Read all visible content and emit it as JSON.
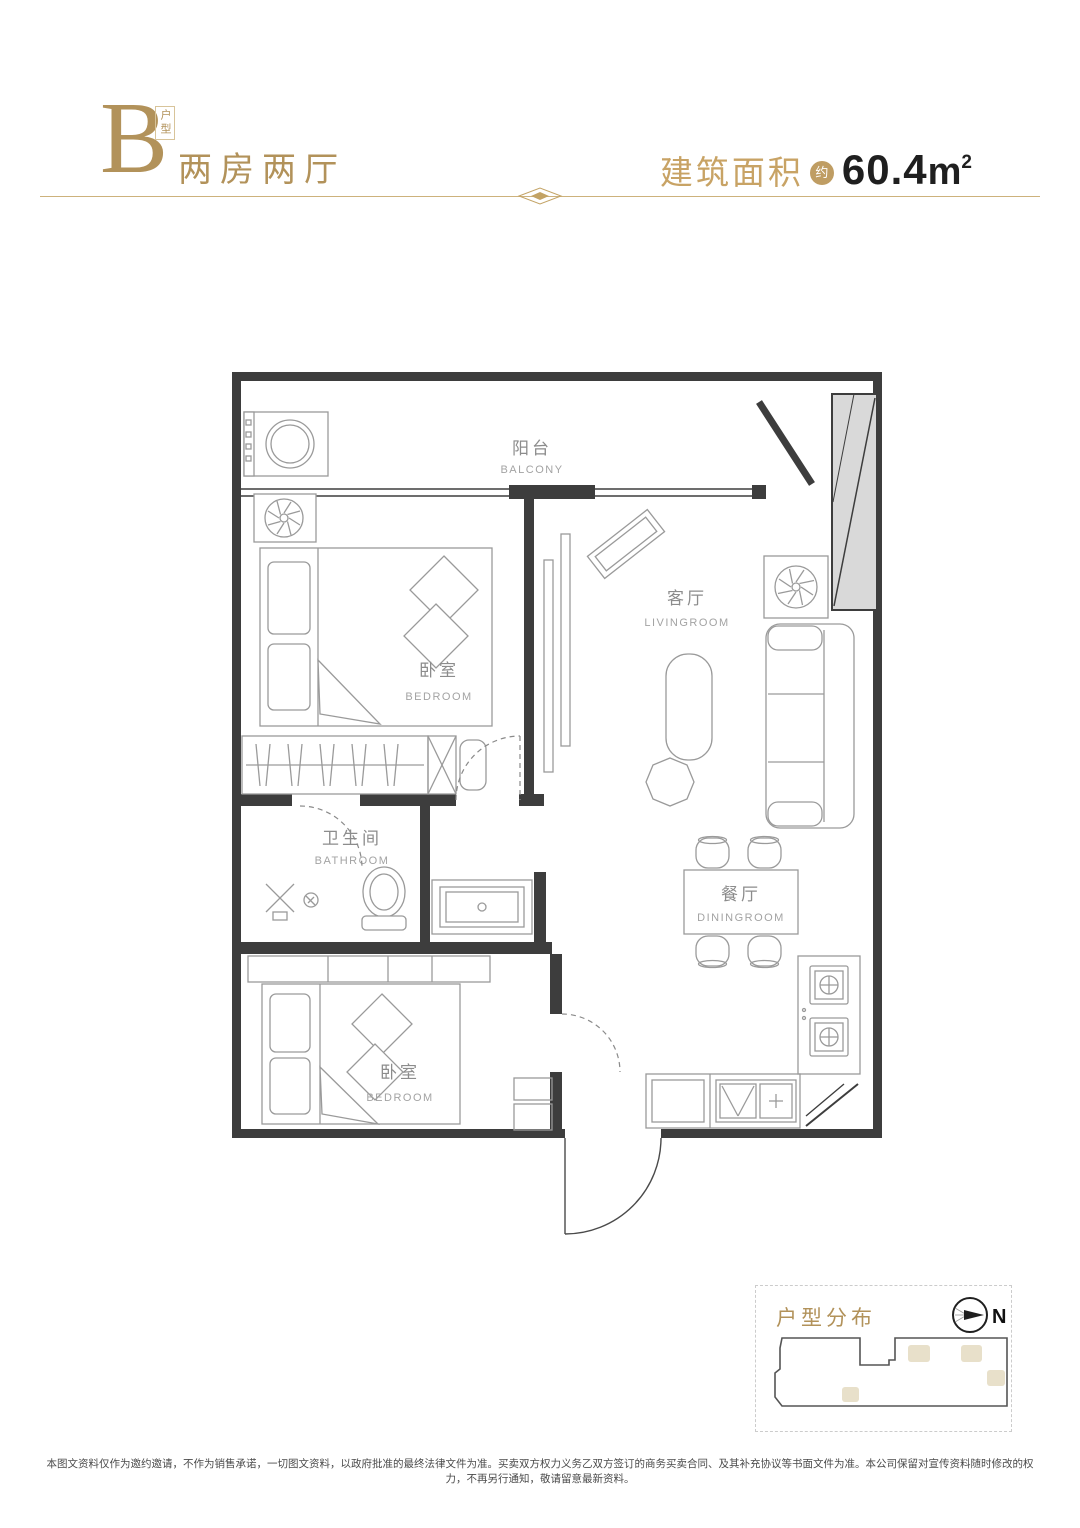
{
  "header": {
    "type_letter": "B",
    "type_tag": "户型",
    "layout_name": "两房两厅",
    "area_label": "建筑面积",
    "area_badge": "约",
    "area_value": "60.4",
    "area_unit": "m",
    "area_exp": "2"
  },
  "floorplan": {
    "balcony_zh": "阳台",
    "balcony_en": "BALCONY",
    "bedroom_top_zh": "卧室",
    "bedroom_top_en": "BEDROOM",
    "living_zh": "客厅",
    "living_en": "LIVINGROOM",
    "bath_zh": "卫生间",
    "bath_en": "BATHROOM",
    "dining_zh": "餐厅",
    "dining_en": "DININGROOM",
    "bedroom_bottom_zh": "卧室",
    "bedroom_bottom_en": "BEDROOM"
  },
  "distribution": {
    "title": "户型分布",
    "north_label": "N"
  },
  "footer": {
    "disclaimer": "本图文资料仅作为邀约邀请，不作为销售承诺，一切图文资料，以政府批准的最终法律文件为准。买卖双方权力义务乙双方签订的商务买卖合同、及其补充协议等书面文件为准。本公司保留对宣传资料随时修改的权力，不再另行通知，敬请留意最新资料。"
  },
  "colors": {
    "gold": "#b2925a",
    "dark_text": "#1f1f1f",
    "wall": "#3d3d3d",
    "furniture_line": "#9a9a9a",
    "room_label": "#8c8c8c",
    "shaft_fill": "#d9d9d9",
    "unit_highlight": "#e8e0ca"
  }
}
